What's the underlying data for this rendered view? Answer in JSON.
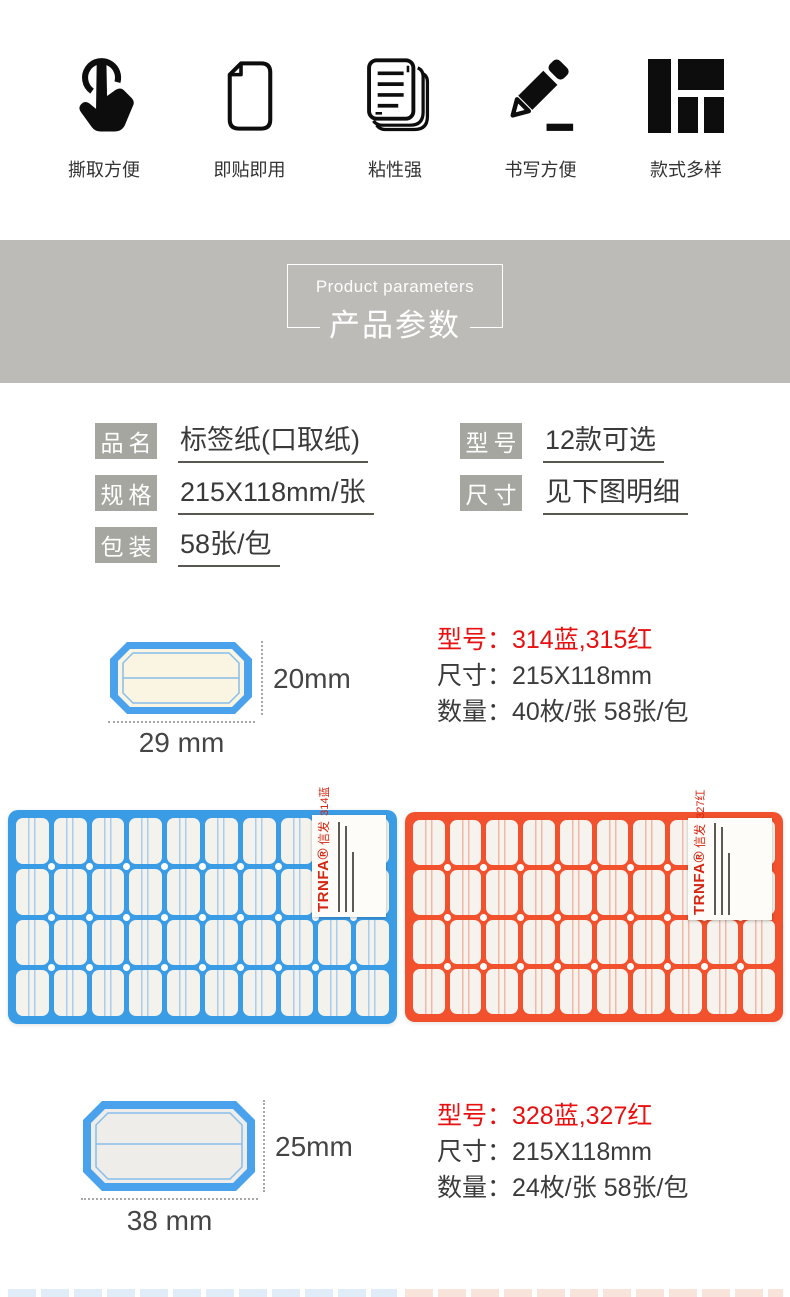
{
  "features": [
    {
      "icon": "tap-icon",
      "label": "撕取方便"
    },
    {
      "icon": "page-icon",
      "label": "即贴即用"
    },
    {
      "icon": "notes-stack-icon",
      "label": "粘性强"
    },
    {
      "icon": "pencil-icon",
      "label": "书写方便"
    },
    {
      "icon": "layout-grid-icon",
      "label": "款式多样"
    }
  ],
  "banner": {
    "title_en": "Product parameters",
    "title_cn": "产品参数"
  },
  "parameters": {
    "left": [
      {
        "label": "品名",
        "value": "标签纸(口取纸)"
      },
      {
        "label": "规格",
        "value": "215X118mm/张"
      },
      {
        "label": "包装",
        "value": "58张/包"
      }
    ],
    "right": [
      {
        "label": "型号",
        "value": "12款可选"
      },
      {
        "label": "尺寸",
        "value": "见下图明细"
      }
    ]
  },
  "spec_blocks": [
    {
      "height_label": "20mm",
      "width_label": "29 mm",
      "model_line": "型号：314蓝,315红",
      "size_line": "尺寸：215X118mm",
      "qty_line": "数量：40枚/张 58张/包"
    },
    {
      "height_label": "25mm",
      "width_label": "38 mm",
      "model_line": "型号：328蓝,327红",
      "size_line": "尺寸：215X118mm",
      "qty_line": "数量：24枚/张 58张/包"
    }
  ],
  "sheets": [
    {
      "name": "blue-label-sheet",
      "color": "#3b9ce6",
      "cell_bg": "#f4f2ed",
      "line_color": "#a9cdf0",
      "cols": 10,
      "rows": 4,
      "sticker": {
        "brand": "TRNFA®",
        "brand_cn": "信发",
        "model": "314蓝"
      }
    },
    {
      "name": "red-label-sheet",
      "color": "#f1512c",
      "cell_bg": "#f6f3ee",
      "line_color": "#f3b7a6",
      "cols": 10,
      "rows": 4,
      "sticker": {
        "brand": "TRNFA®",
        "brand_cn": "信发",
        "model": "327红"
      }
    }
  ],
  "colors": {
    "accent_red": "#e81010",
    "banner_gray": "#bcbbb7",
    "label_gray": "#a6a6a1",
    "sheet_blue": "#3b9ce6",
    "sheet_red": "#f1512c"
  }
}
